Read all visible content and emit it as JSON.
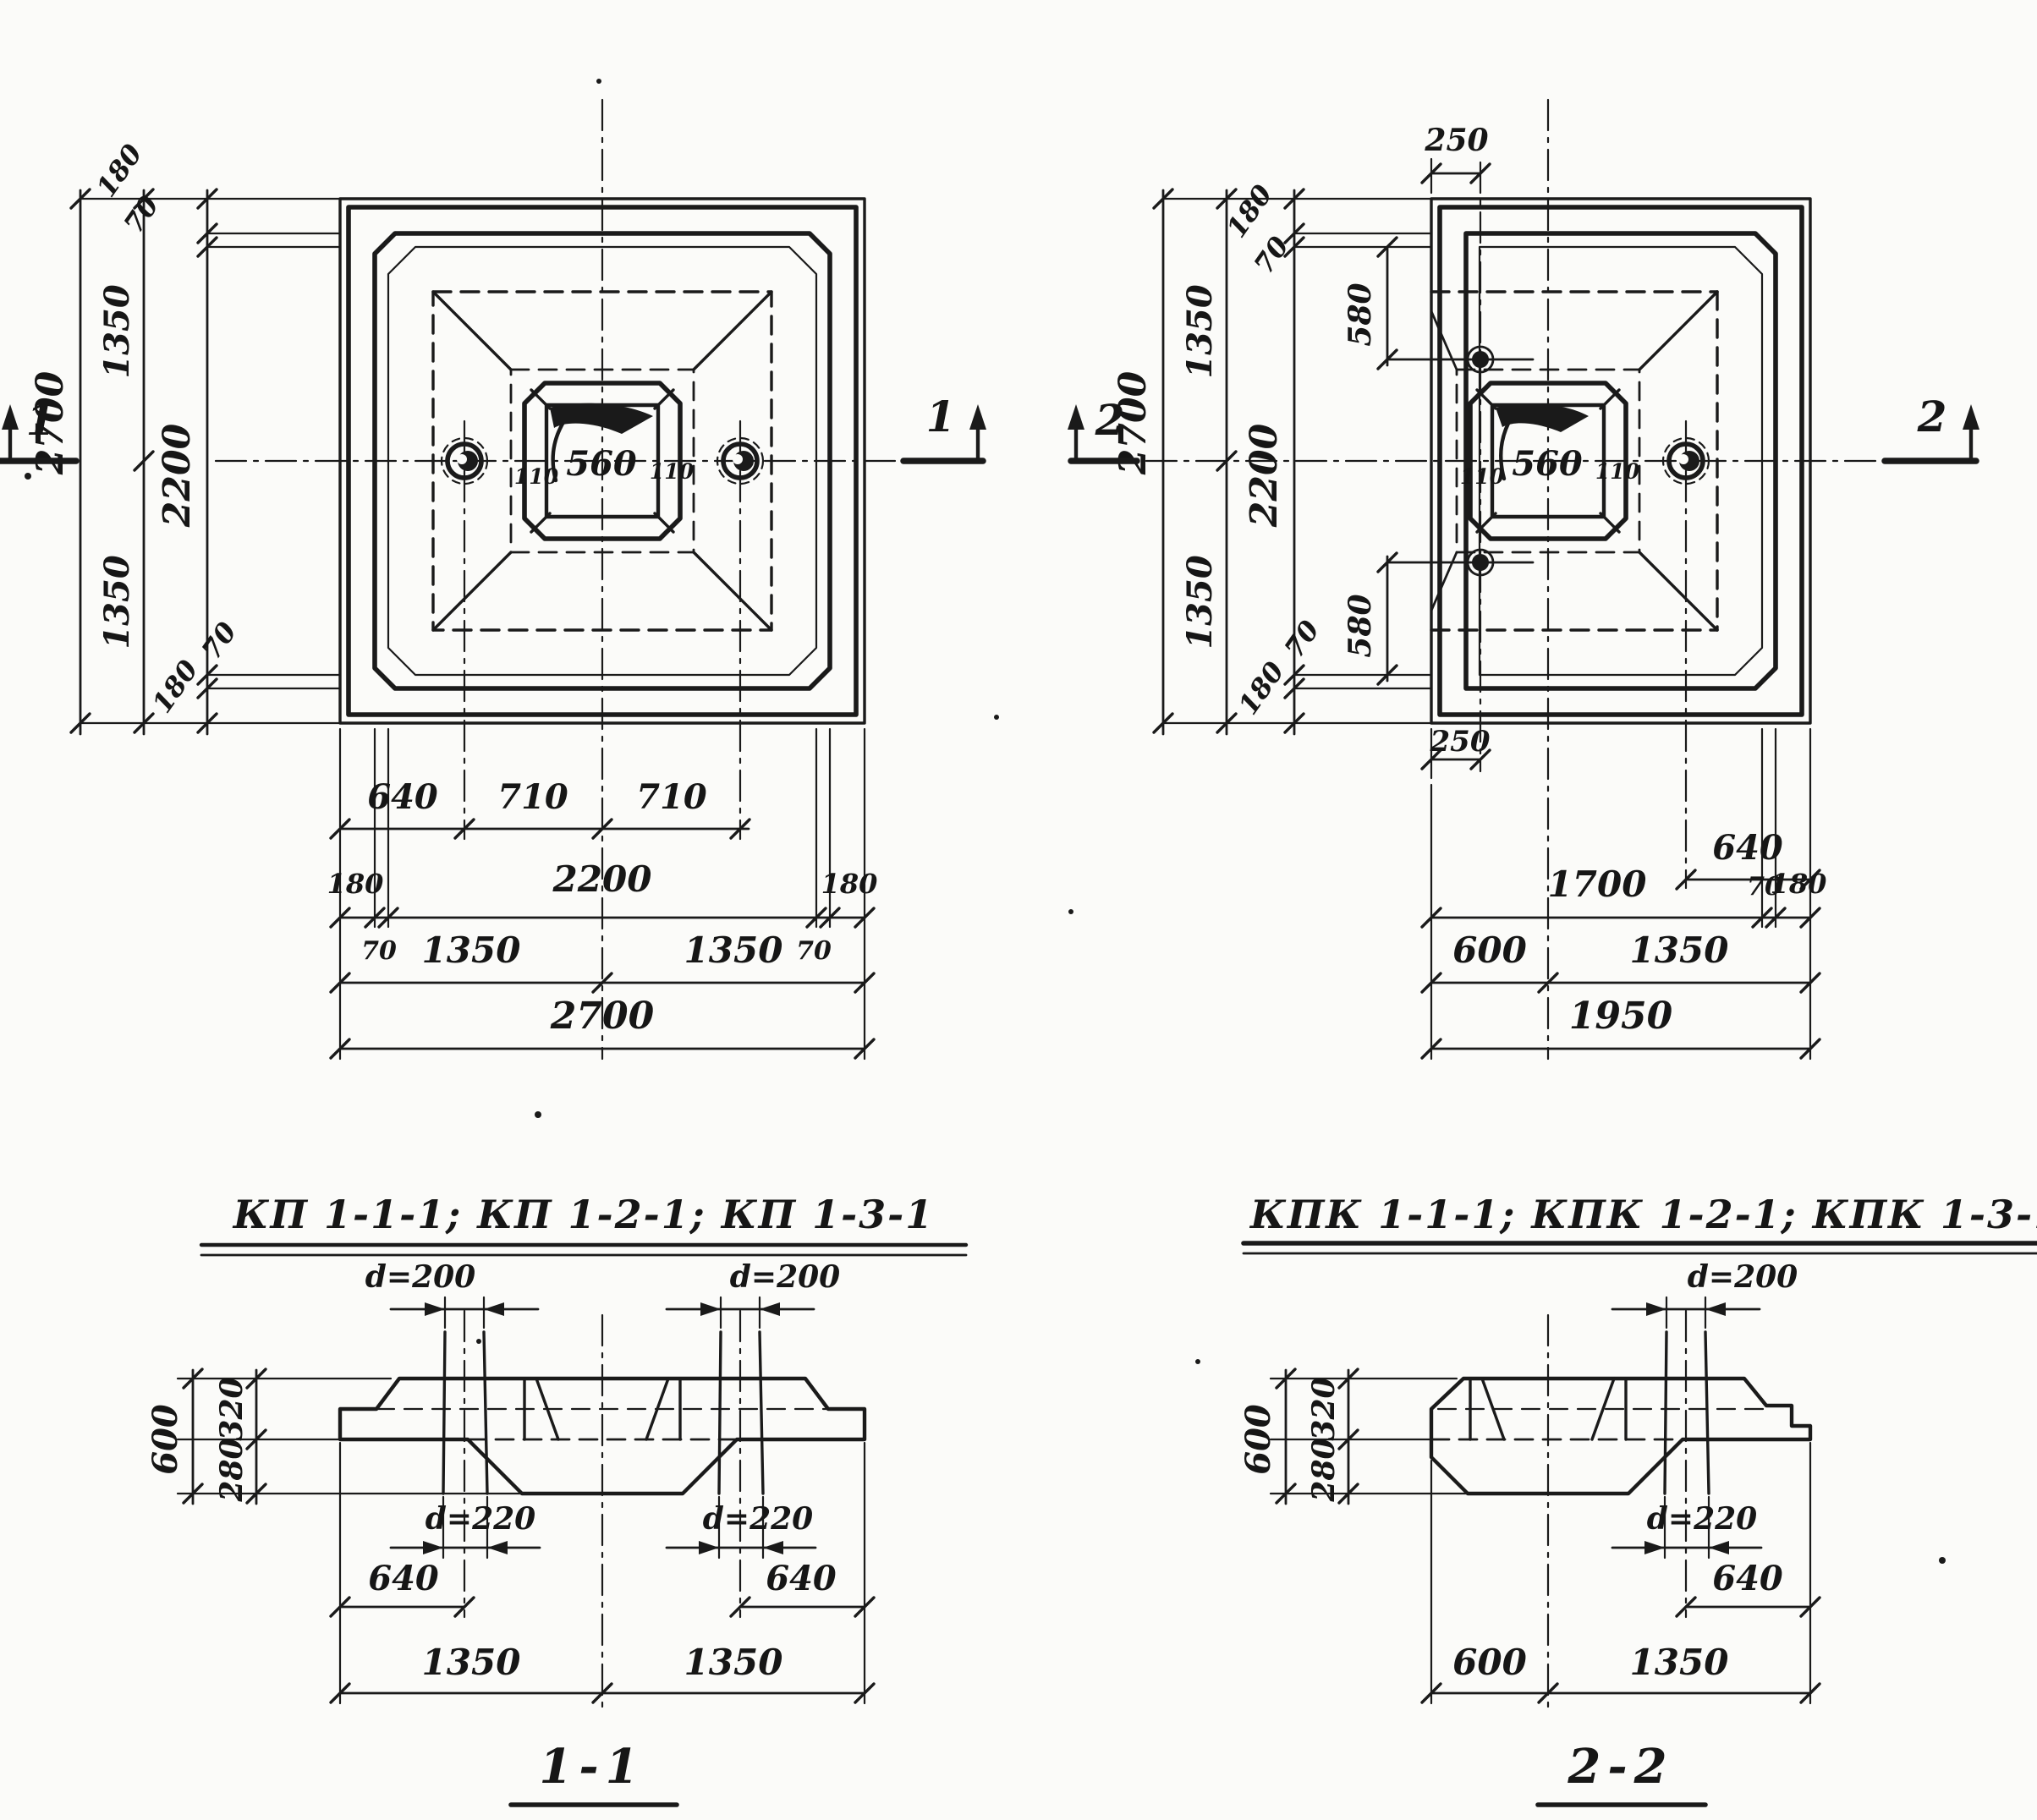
{
  "sheet": {
    "background": "#fbfbf9",
    "ink": "#1a1a1a"
  },
  "plans": {
    "left": {
      "title": "КП 1-1-1; КП 1-2-1; КП 1-3-1",
      "marker_left": "1",
      "marker_right": "1",
      "socket": {
        "left": "110",
        "center": "560",
        "right": "110"
      },
      "dims": {
        "total_v": "2700",
        "half_top": "1350",
        "half_bottom": "1350",
        "mid_v": "2200",
        "edge_top_180": "180",
        "edge_top_70": "70",
        "edge_bot_70": "70",
        "edge_bot_180": "180",
        "row1_640": "640",
        "row1_710a": "710",
        "row1_710b": "710",
        "row2_180l": "180",
        "row2_2200": "2200",
        "row2_180r": "180",
        "row2_70l": "70",
        "row2_70r": "70",
        "row3_1350a": "1350",
        "row3_1350b": "1350",
        "row4_2700": "2700"
      }
    },
    "right": {
      "title": "КПК 1-1-1; КПК 1-2-1; КПК 1-3-1",
      "marker_left": "2",
      "marker_right": "2",
      "socket": {
        "left": "110",
        "center": "560",
        "right": "110"
      },
      "dims": {
        "top_250": "250",
        "bot_250": "250",
        "total_v": "2700",
        "half_top": "1350",
        "half_bottom": "1350",
        "mid_v": "2200",
        "edge_top_180": "180",
        "edge_top_70": "70",
        "v580_top": "580",
        "v580_bot": "580",
        "edge_bot_70": "70",
        "edge_bot_180": "180",
        "row1_640": "640",
        "row2_1700": "1700",
        "row2_70": "70",
        "row2_180": "180",
        "row3_600": "600",
        "row3_1350": "1350",
        "row4_1950": "1950"
      }
    }
  },
  "sections": {
    "s11": {
      "title": "1-1",
      "d200_left": "d=200",
      "d200_right": "d=200",
      "d220_left": "d=220",
      "d220_right": "d=220",
      "v600": "600",
      "v320": "320",
      "v280": "280",
      "h640_left": "640",
      "h640_right": "640",
      "h1350_left": "1350",
      "h1350_right": "1350"
    },
    "s22": {
      "title": "2-2",
      "d200": "d=200",
      "d220": "d=220",
      "v600": "600",
      "v320": "320",
      "v280": "280",
      "h640": "640",
      "h600": "600",
      "h1350": "1350"
    }
  }
}
